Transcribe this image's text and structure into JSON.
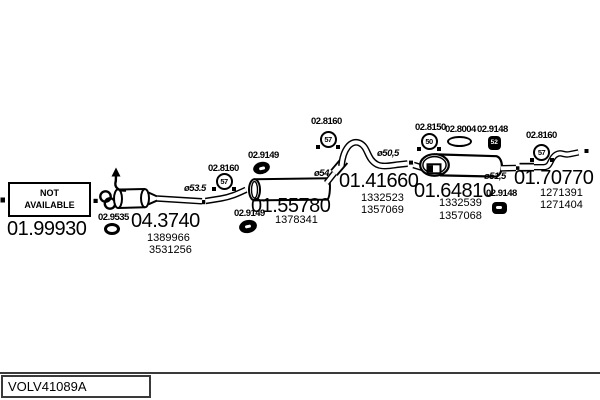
{
  "footer": {
    "code": "VOLV41089A"
  },
  "na_box": {
    "line1": "NOT",
    "line2": "AVAILABLE"
  },
  "parts": {
    "front_pipe": {
      "code": "01.99930"
    },
    "catalyst": {
      "code": "04.3740",
      "oe1": "1389966",
      "oe2": "3531256"
    },
    "mid_muffler": {
      "code": "01.55780",
      "oe1": "1378341"
    },
    "conn_pipe": {
      "code": "01.41660",
      "oe1": "1332523",
      "oe2": "1357069"
    },
    "rear_muffler": {
      "code": "01.64810",
      "oe1": "1332539",
      "oe2": "1357068"
    },
    "tail_pipe": {
      "code": "01.70770",
      "oe1": "1271391",
      "oe2": "1271404"
    }
  },
  "fittings": {
    "oring": {
      "code": "02.9535"
    },
    "clamp_front": {
      "code": "02.8160",
      "size": "57"
    },
    "hanger_mid_top": {
      "code": "02.9149"
    },
    "hanger_mid_bottom": {
      "code": "02.9149"
    },
    "clamp_mid": {
      "code": "02.8160",
      "size": "57"
    },
    "clamp_rear": {
      "code": "02.8150",
      "size": "50"
    },
    "gasket_rear": {
      "code": "02.8004"
    },
    "hanger_rear_top": {
      "code": "02.9148",
      "size": "52"
    },
    "hanger_rear_bottom": {
      "code": "02.9148"
    },
    "clamp_tail": {
      "code": "02.8160",
      "size": "57"
    }
  },
  "dimensions": {
    "pipe_front": "ø53.5",
    "mid_outlet": "ø54",
    "conn_pipe": "ø50,5",
    "rear_outlet": "ø51,5"
  },
  "colors": {
    "line": "#000000",
    "background": "#ffffff",
    "frame": "#3a3a3a"
  }
}
